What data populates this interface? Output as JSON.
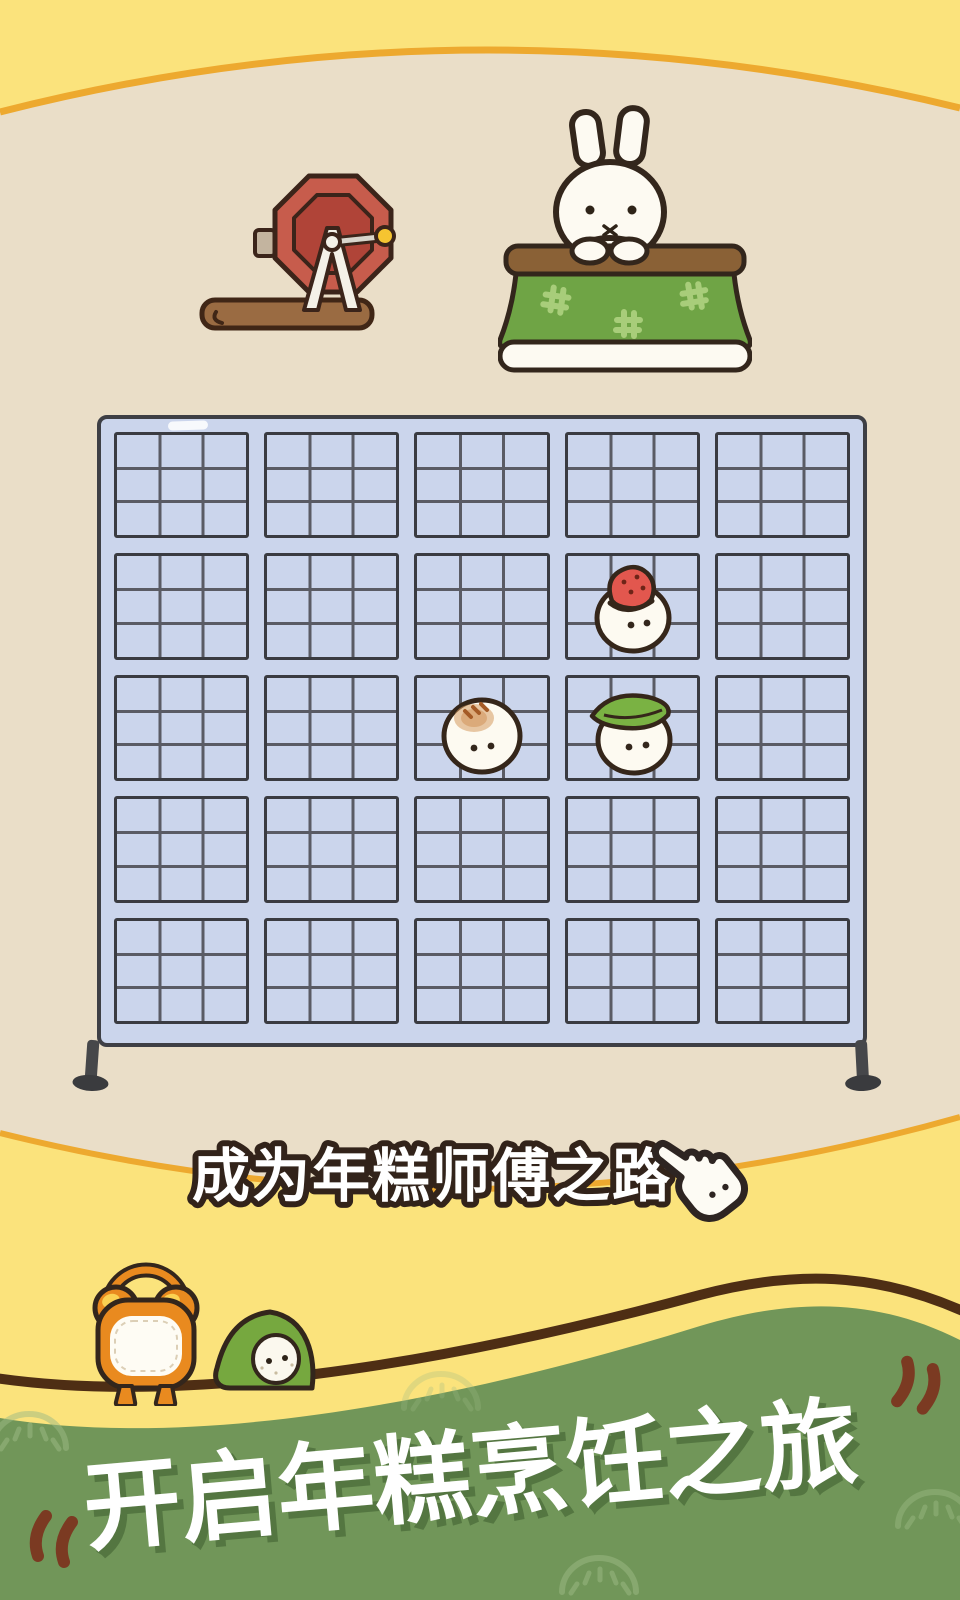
{
  "app": {
    "name": "rice-cake-game-title-screen"
  },
  "caption": {
    "label": "成为年糕师傅之路",
    "icon": "pointing-hand"
  },
  "headline": {
    "text": "开启年糕烹饪之旅",
    "open_quote": "〝",
    "close_quote": "〞"
  },
  "grid": {
    "cols": 5,
    "rows": 5,
    "inner_cols": 3,
    "inner_rows": 3,
    "items": [
      {
        "type": "strawberry-mochi",
        "col": 4,
        "row": 2
      },
      {
        "type": "plain-bun-mochi",
        "col": 3,
        "row": 3
      },
      {
        "type": "leaf-mochi",
        "col": 4,
        "row": 3
      }
    ]
  },
  "decor": {
    "machine": "gacha-lottery-machine",
    "rabbit_scene": "rabbit-at-kotatsu",
    "kotatsu_pattern": "#",
    "hillside_characters": [
      "alarm-clock-mochi",
      "green-hooded-mochi"
    ]
  },
  "colors": {
    "yellow": "#FBE37C",
    "beige": "#EADEC8",
    "arc_stroke": "#EDA92F",
    "ring": "#F0BA8A",
    "ring_halo": "#F6CEA6",
    "rack_frame": "#CBD5EC",
    "rack_outline": "#3E3F45",
    "hill_green": "#719659",
    "hill_stroke": "#4E2E14",
    "quote": "#7B3A22",
    "title_white": "#FFFFFF",
    "caption_outline": "#32231A",
    "machine_red": "#C75C4C",
    "clock_orange": "#E98A1F",
    "kotatsu_green": "#6FA445"
  }
}
